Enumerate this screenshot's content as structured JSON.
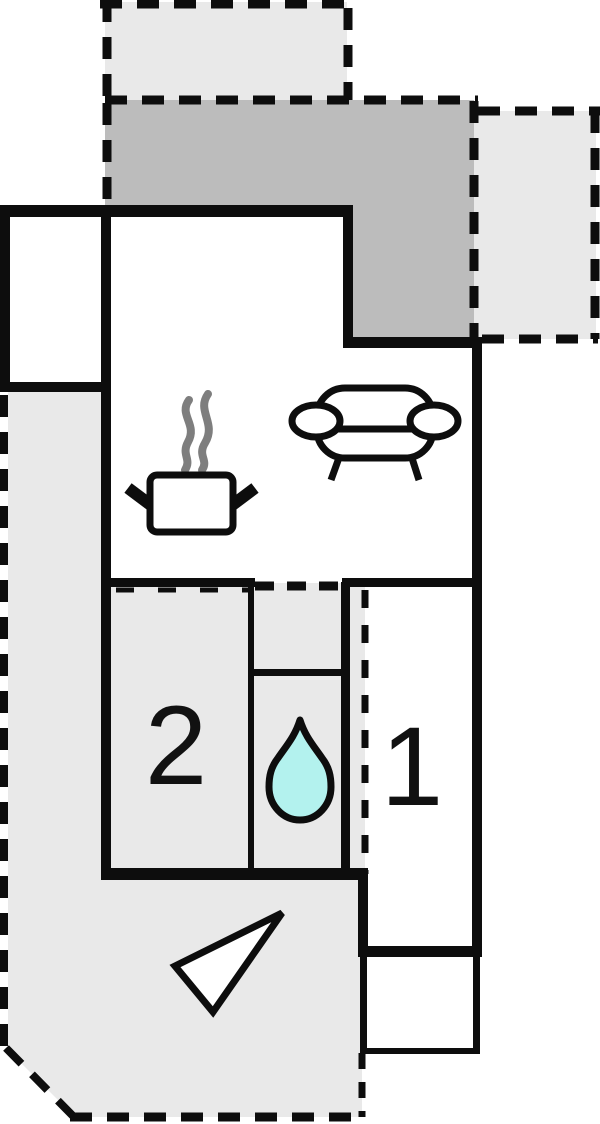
{
  "plan": {
    "type": "floor-plan",
    "rooms": {
      "bedroom_2": {
        "label": "2"
      },
      "bedroom_1": {
        "label": "1"
      }
    },
    "icons": {
      "sofa": "sofa-icon",
      "cooking_pot": "cooking-pot-icon",
      "steam": "steam-icon",
      "water_drop": "water-drop-icon",
      "compass_arrow": "compass-arrow-icon"
    },
    "areas": [
      "top-balcony",
      "covered-terrace-upper",
      "right-balcony",
      "living-room-kitchen",
      "entry-room",
      "bedroom-2",
      "shower-room",
      "bedroom-1",
      "lower-terrace",
      "utility-room"
    ]
  },
  "colors": {
    "wall": "#0d0d0d",
    "room_fill": "#ffffff",
    "terrace_fill": "#e9e9e9",
    "covered_terrace_fill": "#bcbcbc",
    "steam": "#7e7e7e",
    "water": "#b3f2ee",
    "label": "#111111"
  }
}
